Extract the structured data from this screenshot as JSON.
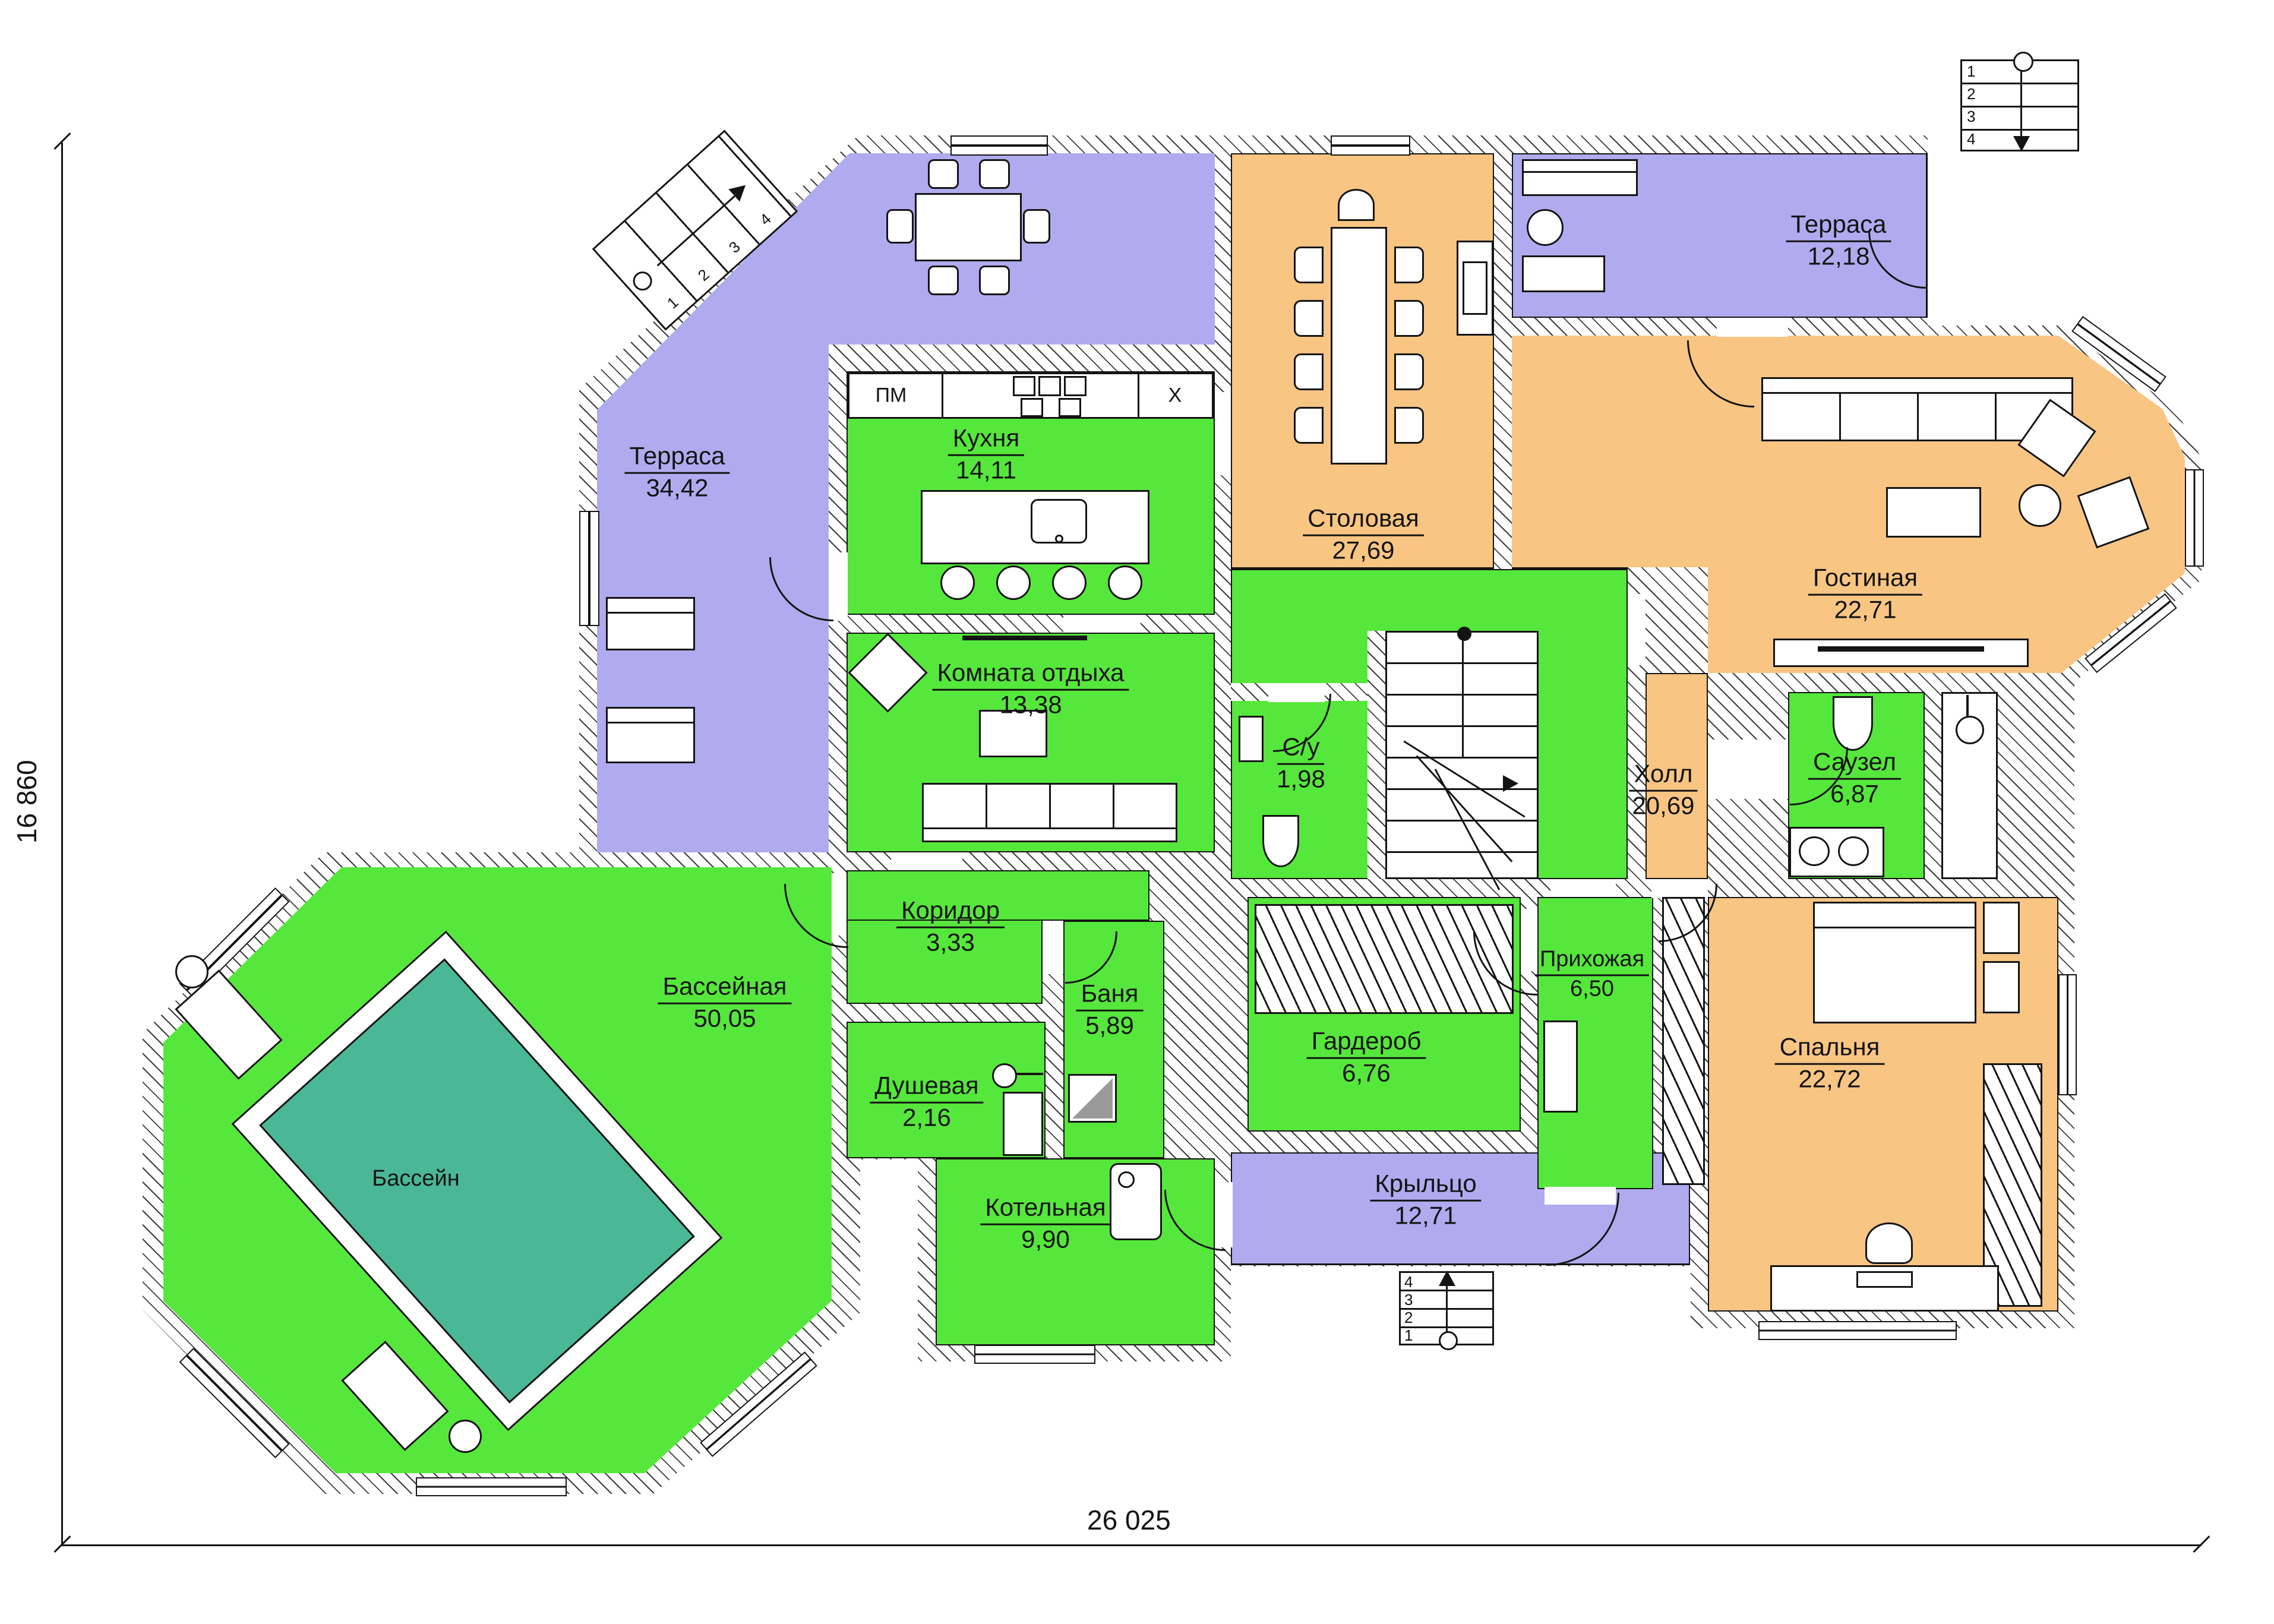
{
  "palette": {
    "room_green": "#56e73c",
    "terrace_purple": "#b0abef",
    "living_orange": "#f9c583",
    "pool_teal": "#4ab795",
    "wall_line": "#141414"
  },
  "dimensions": {
    "height_label": "16 860",
    "width_label": "26 025"
  },
  "rooms": {
    "terrace_left": {
      "name": "Терраса",
      "area": "34,42"
    },
    "kitchen": {
      "name": "Кухня",
      "area": "14,11"
    },
    "dining": {
      "name": "Столовая",
      "area": "27,69"
    },
    "terrace_top": {
      "name": "Терраса",
      "area": "12,18"
    },
    "living": {
      "name": "Гостиная",
      "area": "22,71"
    },
    "lounge": {
      "name": "Комната отдыха",
      "area": "13,38"
    },
    "wc": {
      "name": "С/у",
      "area": "1,98"
    },
    "hall": {
      "name": "Холл",
      "area": "20,69"
    },
    "bathroom": {
      "name": "Саузел",
      "area": "6,87"
    },
    "corridor": {
      "name": "Коридор",
      "area": "3,33"
    },
    "banya": {
      "name": "Баня",
      "area": "5,89"
    },
    "pool_room": {
      "name": "Бассейная",
      "area": "50,05"
    },
    "pool": {
      "name": "Бассейн"
    },
    "shower": {
      "name": "Душевая",
      "area": "2,16"
    },
    "wardrobe": {
      "name": "Гардероб",
      "area": "6,76"
    },
    "entry": {
      "name": "Прихожая",
      "area": "6,50"
    },
    "boiler": {
      "name": "Котельная",
      "area": "9,90"
    },
    "porch": {
      "name": "Крыльцо",
      "area": "12,71"
    },
    "bedroom": {
      "name": "Спальня",
      "area": "22,72"
    }
  },
  "kitchen_labels": {
    "dishwasher": "ПМ",
    "fridge": "X"
  },
  "steps": [
    "1",
    "2",
    "3",
    "4"
  ]
}
